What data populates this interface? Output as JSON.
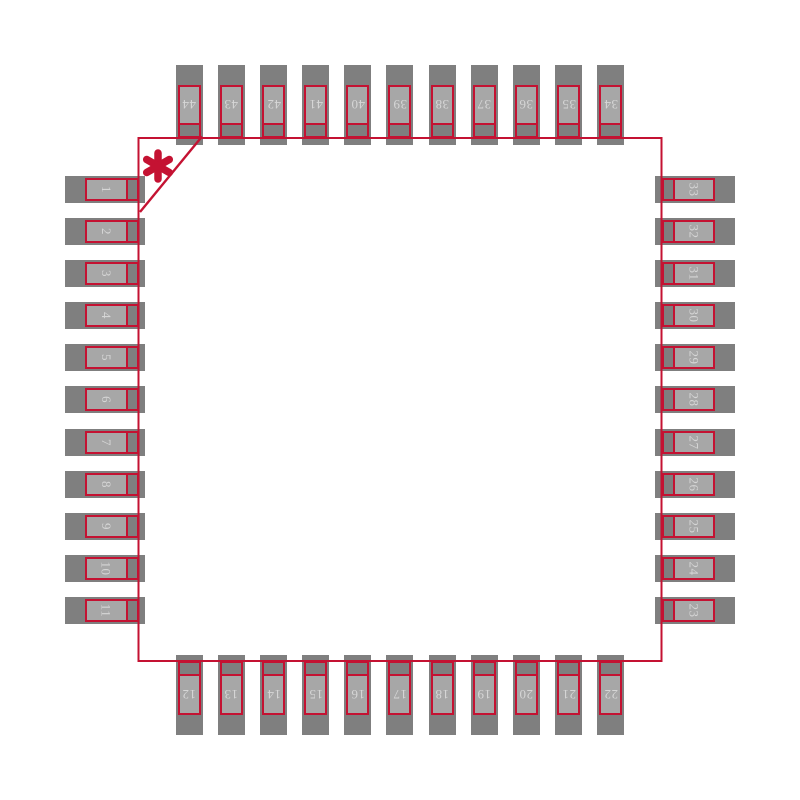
{
  "diagram": {
    "kind": "ic-package-footprint-land-pattern",
    "pin_count_visible": 44,
    "pin1_marker_glyph": "*"
  },
  "colors": {
    "background": "#ffffff",
    "pad_dark_gray": "#7f7f7f",
    "pad_light_gray": "#a7a7a7",
    "outline_red": "#c41232",
    "pin_text": "#d6d6d6"
  },
  "pins": {
    "left_top_to_bottom": [
      "1",
      "2",
      "3",
      "4",
      "5",
      "6",
      "7",
      "8",
      "9",
      "10",
      "11"
    ],
    "bottom_left_to_right": [
      "12",
      "13",
      "14",
      "15",
      "16",
      "17",
      "18",
      "19",
      "20",
      "21",
      "22"
    ],
    "right_top_to_bottom": [
      "33",
      "32",
      "31",
      "30",
      "29",
      "28",
      "27",
      "26",
      "25",
      "24",
      "23"
    ],
    "top_left_to_right": [
      "44",
      "43",
      "42",
      "41",
      "40",
      "39",
      "38",
      "37",
      "36",
      "35",
      "34"
    ]
  }
}
